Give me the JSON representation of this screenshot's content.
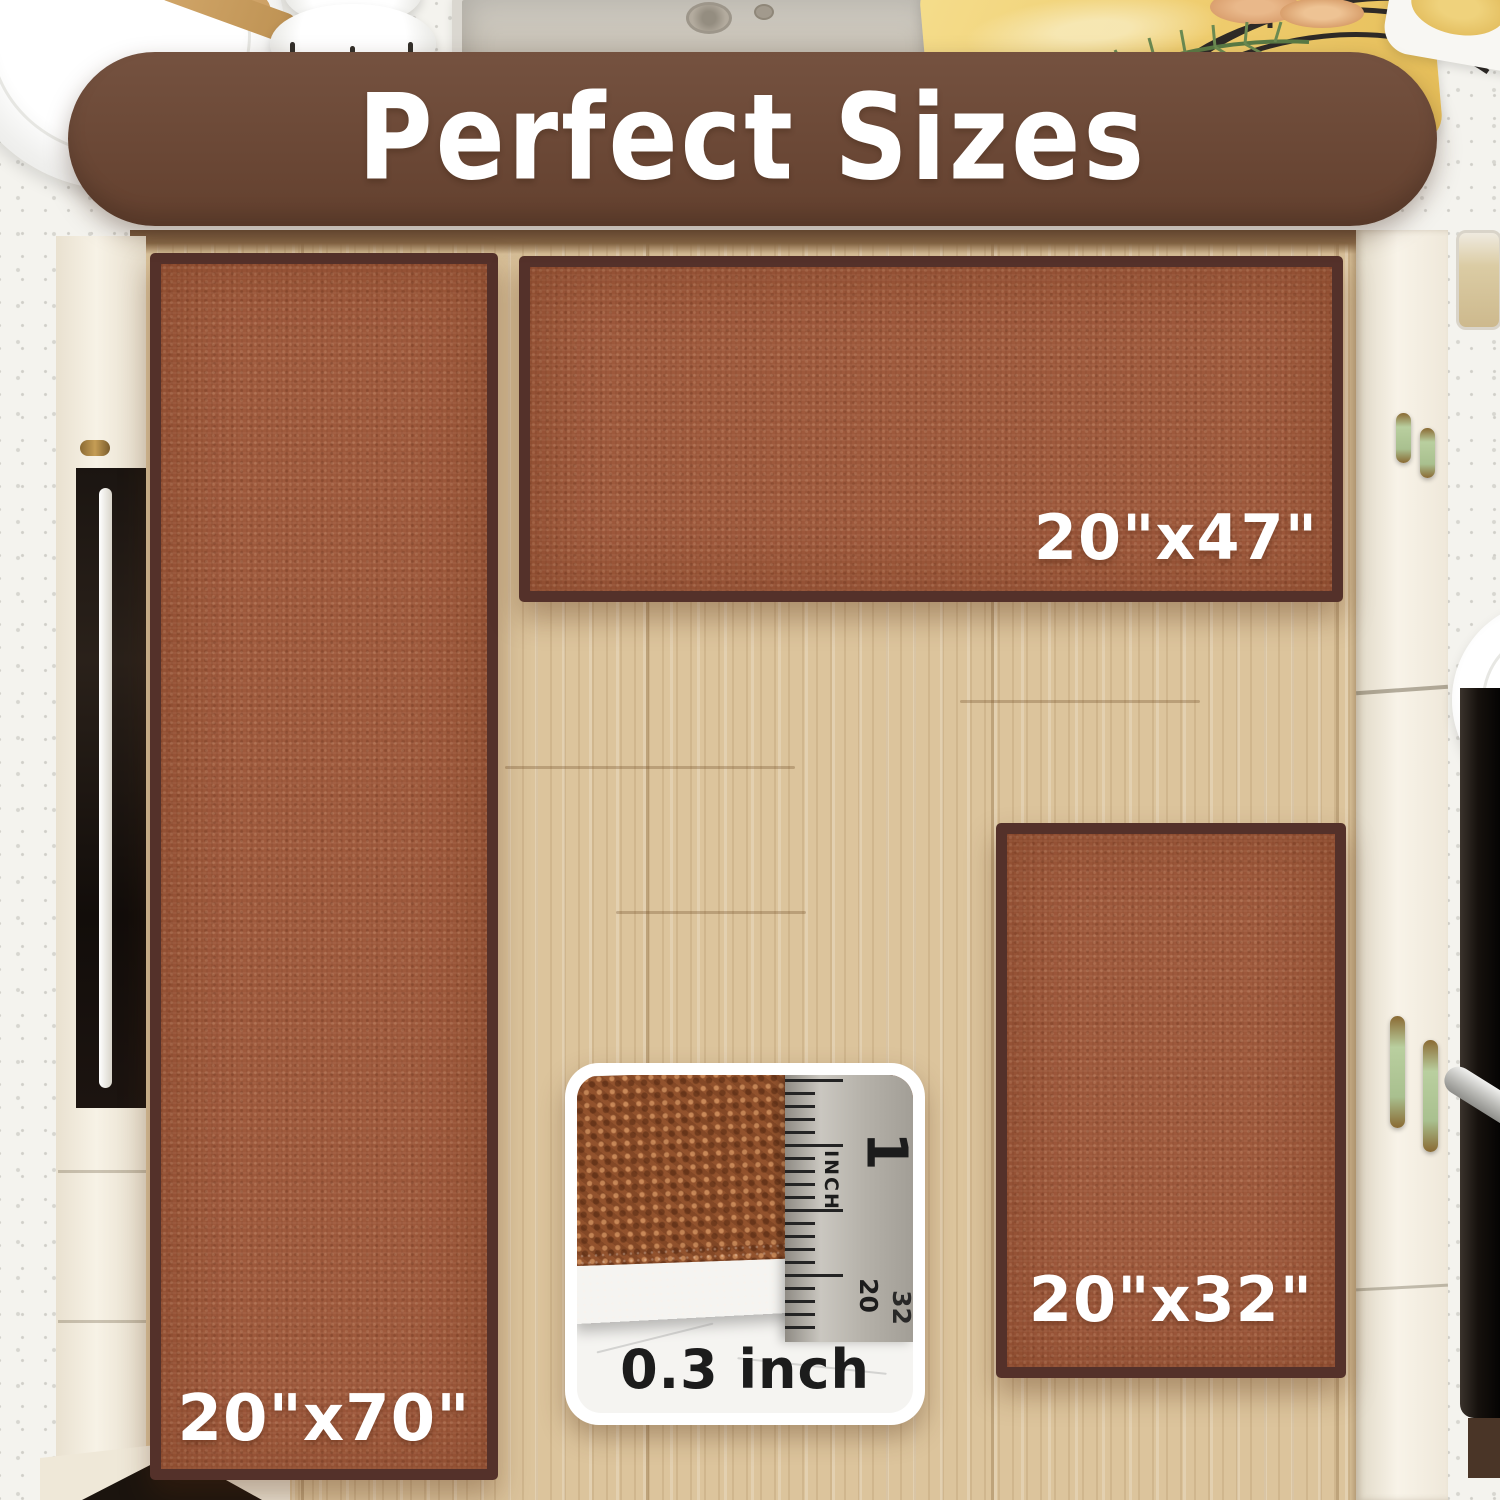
{
  "banner": {
    "title": "Perfect Sizes"
  },
  "rugs": {
    "runner": {
      "size_label": "20\"x70\""
    },
    "wide": {
      "size_label": "20\"x47\""
    },
    "small": {
      "size_label": "20\"x32\""
    }
  },
  "thickness_inset": {
    "thickness_label": "0.3 inch",
    "ruler": {
      "unit_label": "INCH",
      "inch_mark": "1",
      "scale_mark_20": "20",
      "scale_mark_32": "32"
    }
  },
  "colors": {
    "banner_brown": "#6b4836",
    "rug_fill": "#9e593c",
    "rug_border": "#54312a",
    "floor_wood": "#dcc49c",
    "countertop_speckle": "#f4f3ee",
    "cabinet_cream": "#f1ead9",
    "appliance_black": "#16110d",
    "size_label_white": "#ffffff",
    "thickness_text": "#1c1c1c"
  },
  "icons": {
    "whisk": "wire-whisk",
    "rosemary": "rosemary-sprig",
    "sink_drain": "sink-drain"
  }
}
